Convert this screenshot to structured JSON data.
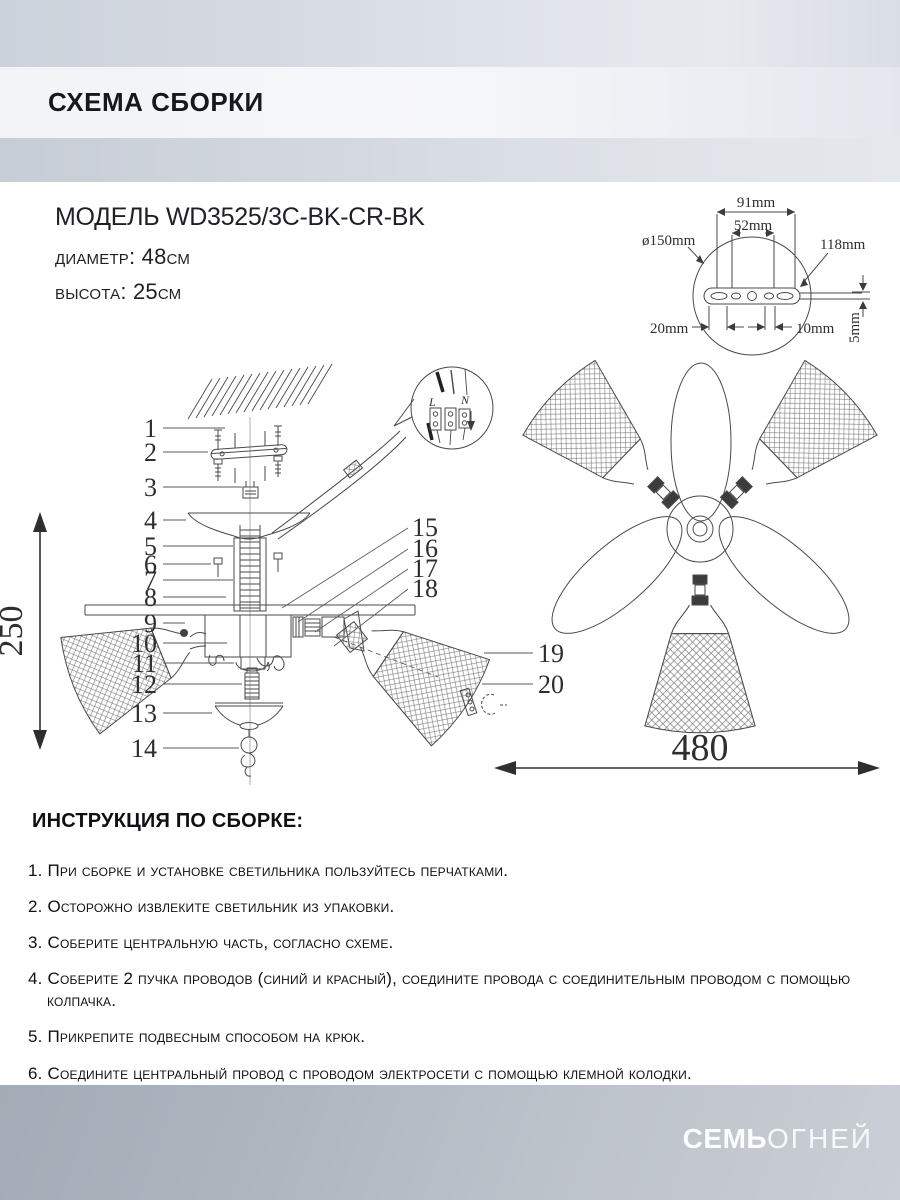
{
  "header": {
    "title": "СХЕМА СБОРКИ"
  },
  "product": {
    "model": "МОДЕЛЬ WD3525/3C-BK-CR-BK",
    "diameter": "диаметр: 48см",
    "height": "высота: 25см"
  },
  "mount": {
    "d91": "91mm",
    "d52": "52mm",
    "d150": "ø150mm",
    "d118": "118mm",
    "d20": "20mm",
    "d10": "10mm",
    "d5": "5mm"
  },
  "diagram": {
    "parts": [
      "1",
      "2",
      "3",
      "4",
      "5",
      "6",
      "7",
      "8",
      "9",
      "10",
      "11",
      "12",
      "13",
      "14",
      "15",
      "16",
      "17",
      "18",
      "19",
      "20"
    ],
    "dim_height": "250",
    "dim_width": "480",
    "terminal_l": "L",
    "terminal_n": "N"
  },
  "instructions": {
    "title": "ИНСТРУКЦИЯ ПО СБОРКЕ:",
    "items": [
      "1. При сборке и установке светильника пользуйтесь перчатками.",
      "2. Осторожно извлеките светильник из упаковки.",
      "3. Соберите центральную часть, согласно схеме.",
      "4. Соберите 2 пучка проводов (синий и красный), соедините провода с соединительным проводом с помощью колпачка.",
      "5. Прикрепите подвесным способом на крюк.",
      "6. Соедините центральный провод с проводом электросети с помощью клемной колодки."
    ]
  },
  "footer": {
    "brand_bold": "СЕМЬ",
    "brand_light": "ОГНЕЙ"
  }
}
